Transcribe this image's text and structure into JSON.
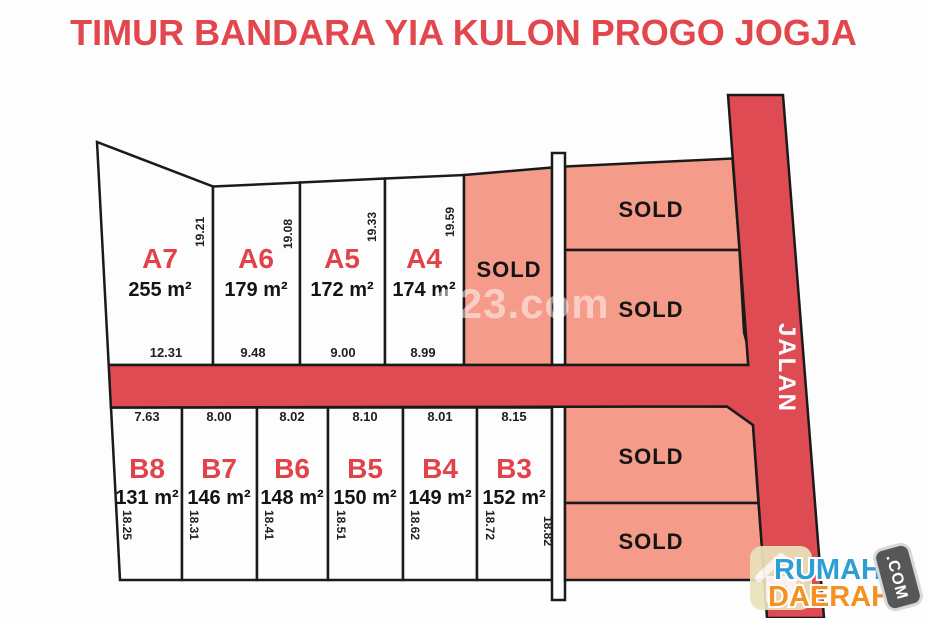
{
  "title": "TIMUR BANDARA YIA KULON PROGO JOGJA",
  "watermark": "123.com",
  "road": {
    "label": "JALAN"
  },
  "sold": {
    "label": "SOLD"
  },
  "plots_top": [
    {
      "id": "A7",
      "area": "255 m²",
      "side": "19.21",
      "front": "12.31"
    },
    {
      "id": "A6",
      "area": "179 m²",
      "side": "19.08",
      "front": "9.48"
    },
    {
      "id": "A5",
      "area": "172 m²",
      "side": "19.33",
      "front": "9.00"
    },
    {
      "id": "A4",
      "area": "174 m²",
      "side": "19.59",
      "front": "8.99"
    }
  ],
  "plots_bottom": [
    {
      "id": "B8",
      "area": "131 m²",
      "side": "18.25",
      "front": "7.63"
    },
    {
      "id": "B7",
      "area": "146 m²",
      "side": "18.31",
      "front": "8.00"
    },
    {
      "id": "B6",
      "area": "148 m²",
      "side": "18.41",
      "front": "8.02"
    },
    {
      "id": "B5",
      "area": "150 m²",
      "side": "18.51",
      "front": "8.10"
    },
    {
      "id": "B4",
      "area": "149 m²",
      "side": "18.62",
      "front": "8.01"
    },
    {
      "id": "B3",
      "area": "152 m²",
      "side": "18.72",
      "front": "8.15",
      "side_right": "18.82"
    }
  ],
  "logo": {
    "name_line1": "RUMAH",
    "name_line2": "DAERAH",
    "badge": ".COM"
  },
  "colors": {
    "title_red": "#e2474d",
    "road_red": "#de4b52",
    "sold_pink": "#f49b89",
    "outline": "#1a1a1a"
  }
}
